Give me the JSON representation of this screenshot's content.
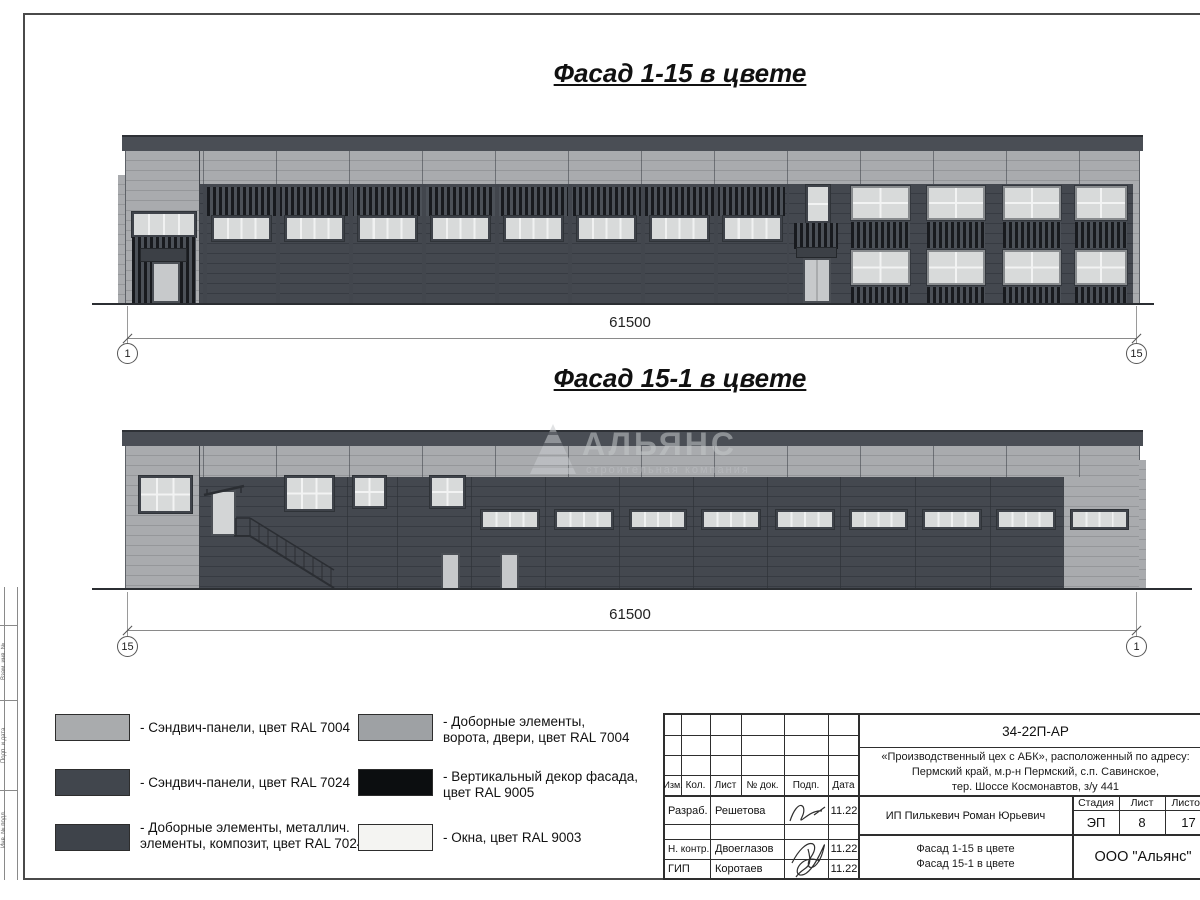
{
  "colors": {
    "ral7004": "#a9abae",
    "ral7024": "#42474e",
    "ral9005": "#0c0e10",
    "ral9003": "#f4f4f2",
    "window_glass": "#d8dada"
  },
  "titles": {
    "facade_top": "Фасад 1-15 в цвете",
    "facade_bottom": "Фасад 15-1 в цвете"
  },
  "dim_top": {
    "value": "61500",
    "axis_left": "1",
    "axis_right": "15"
  },
  "dim_bottom": {
    "value": "61500",
    "axis_left": "15",
    "axis_right": "1"
  },
  "watermark": {
    "name": "АЛЬЯНС",
    "subtitle": "строительная компания"
  },
  "legend": {
    "items": [
      {
        "swatch": "#a9abad",
        "label": "- Сэндвич-панели, цвет RAL 7004"
      },
      {
        "swatch": "#41464d",
        "label": "- Сэндвич-панели, цвет RAL 7024"
      },
      {
        "swatch": "#3e434a",
        "label": "- Доборные элементы, металлич. элементы, композит, цвет RAL 7024"
      },
      {
        "swatch": "#9ea1a4",
        "label": "- Доборные элементы, ворота, двери, цвет RAL 7004"
      },
      {
        "swatch": "#0c0e10",
        "label": "- Вертикальный декор фасада, цвет RAL 9005"
      },
      {
        "swatch": "#f4f4f2",
        "label": "- Окна, цвет RAL 9003"
      }
    ]
  },
  "titleblock": {
    "doc_number": "34-22П-АР",
    "project_line1": "«Производственный цех с АБК», расположенный по адресу:",
    "project_line2": "Пермский край, м.р-н Пермский, с.п. Савинское,",
    "project_line3": "тер. Шоссе Космонавтов, з/у 441",
    "col_izm": "Изм.",
    "col_kol": "Кол.",
    "col_list": "Лист",
    "col_doc": "№ док.",
    "col_podp": "Подп.",
    "col_data": "Дата",
    "row1_role": "Разраб.",
    "row1_name": "Решетова",
    "row1_date": "11.22",
    "row2_role": "Н. контр.",
    "row2_name": "Двоеглазов",
    "row2_date": "11.22",
    "row3_role": "ГИП",
    "row3_name": "Коротаев",
    "row3_date": "11.22",
    "client": "ИП Пилькевич Роман Юрьевич",
    "stage_label": "Стадия",
    "sheet_label": "Лист",
    "sheets_label": "Листов",
    "stage": "ЭП",
    "sheet": "8",
    "sheets": "17",
    "sheet_title_line1": "Фасад 1-15 в цвете",
    "sheet_title_line2": "Фасад 15-1 в цвете",
    "company": "ООО \"Альянс\""
  },
  "margin": {
    "label1": "Взам. инв. №",
    "label2": "Подп. и дата",
    "label3": "Инв. № подл."
  }
}
